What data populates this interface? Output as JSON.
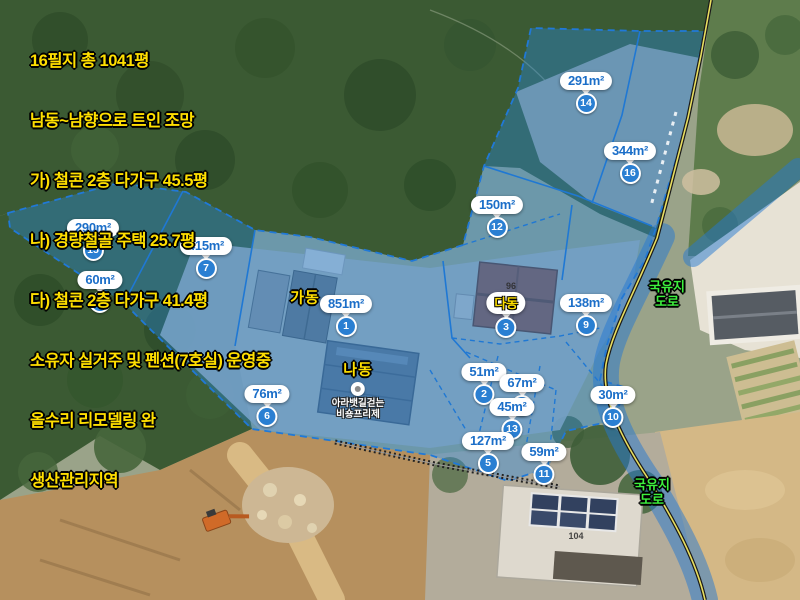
{
  "map_title_overlay": {
    "lines": [
      "16필지 총 1041평",
      "남동~남향으로 트인 조망",
      "가) 철콘 2층 다가구 45.5평",
      "나) 경량철골 주택 25.7평",
      "다) 철콘 2층 다가구 41.4평",
      "소유자 실거주 및 펜션(7호실) 운영중",
      "올수리 리모델링 완",
      "생산관리지역"
    ]
  },
  "parcels": [
    {
      "area": "291m²",
      "no": "14",
      "x": 586,
      "y": 72
    },
    {
      "area": "344m²",
      "no": "16",
      "x": 630,
      "y": 142
    },
    {
      "area": "150m²",
      "no": "12",
      "x": 497,
      "y": 196
    },
    {
      "area": "290m²",
      "no": "15",
      "x": 93,
      "y": 219
    },
    {
      "area": "415m²",
      "no": "7",
      "x": 206,
      "y": 237
    },
    {
      "area": "60m²",
      "no": "8",
      "x": 100,
      "y": 271
    },
    {
      "area": "851m²",
      "no": "1",
      "x": 346,
      "y": 295
    },
    {
      "area": "138m²",
      "no": "9",
      "x": 586,
      "y": 294
    },
    {
      "area": "51m²",
      "no": "2",
      "x": 484,
      "y": 363
    },
    {
      "area": "67m²",
      "no": "4",
      "x": 522,
      "y": 374
    },
    {
      "area": "45m²",
      "no": "13",
      "x": 512,
      "y": 398
    },
    {
      "area": "127m²",
      "no": "5",
      "x": 488,
      "y": 432
    },
    {
      "area": "59m²",
      "no": "11",
      "x": 544,
      "y": 443
    },
    {
      "area": "30m²",
      "no": "10",
      "x": 613,
      "y": 386
    },
    {
      "area": "76m²",
      "no": "6",
      "x": 267,
      "y": 385
    }
  ],
  "building_labels": [
    {
      "text": "가동",
      "x": 305,
      "y": 297
    },
    {
      "text": "나동",
      "x": 358,
      "y": 369
    }
  ],
  "dadong": {
    "label": "다동",
    "no": "3"
  },
  "road_labels": [
    {
      "line1": "국유지",
      "line2": "도로",
      "x": 667,
      "y": 279
    },
    {
      "line1": "국유지",
      "line2": "도로",
      "x": 652,
      "y": 477
    }
  ],
  "poi": {
    "line1": "아라뱃길걷는",
    "line2": "비숑프리제"
  },
  "ground_texts": [
    {
      "text": "104",
      "x": 576,
      "y": 531
    },
    {
      "text": "96",
      "x": 511,
      "y": 281
    }
  ],
  "colors": {
    "parcel_overlay_blue": "#1f7ad2",
    "marker_text_blue": "#1b6ec8",
    "number_badge_blue": "#2a7fd2",
    "annotation_yellow": "#ffdf00",
    "road_label_green": "#3df03d",
    "poi_text_white": "#ffffff"
  }
}
